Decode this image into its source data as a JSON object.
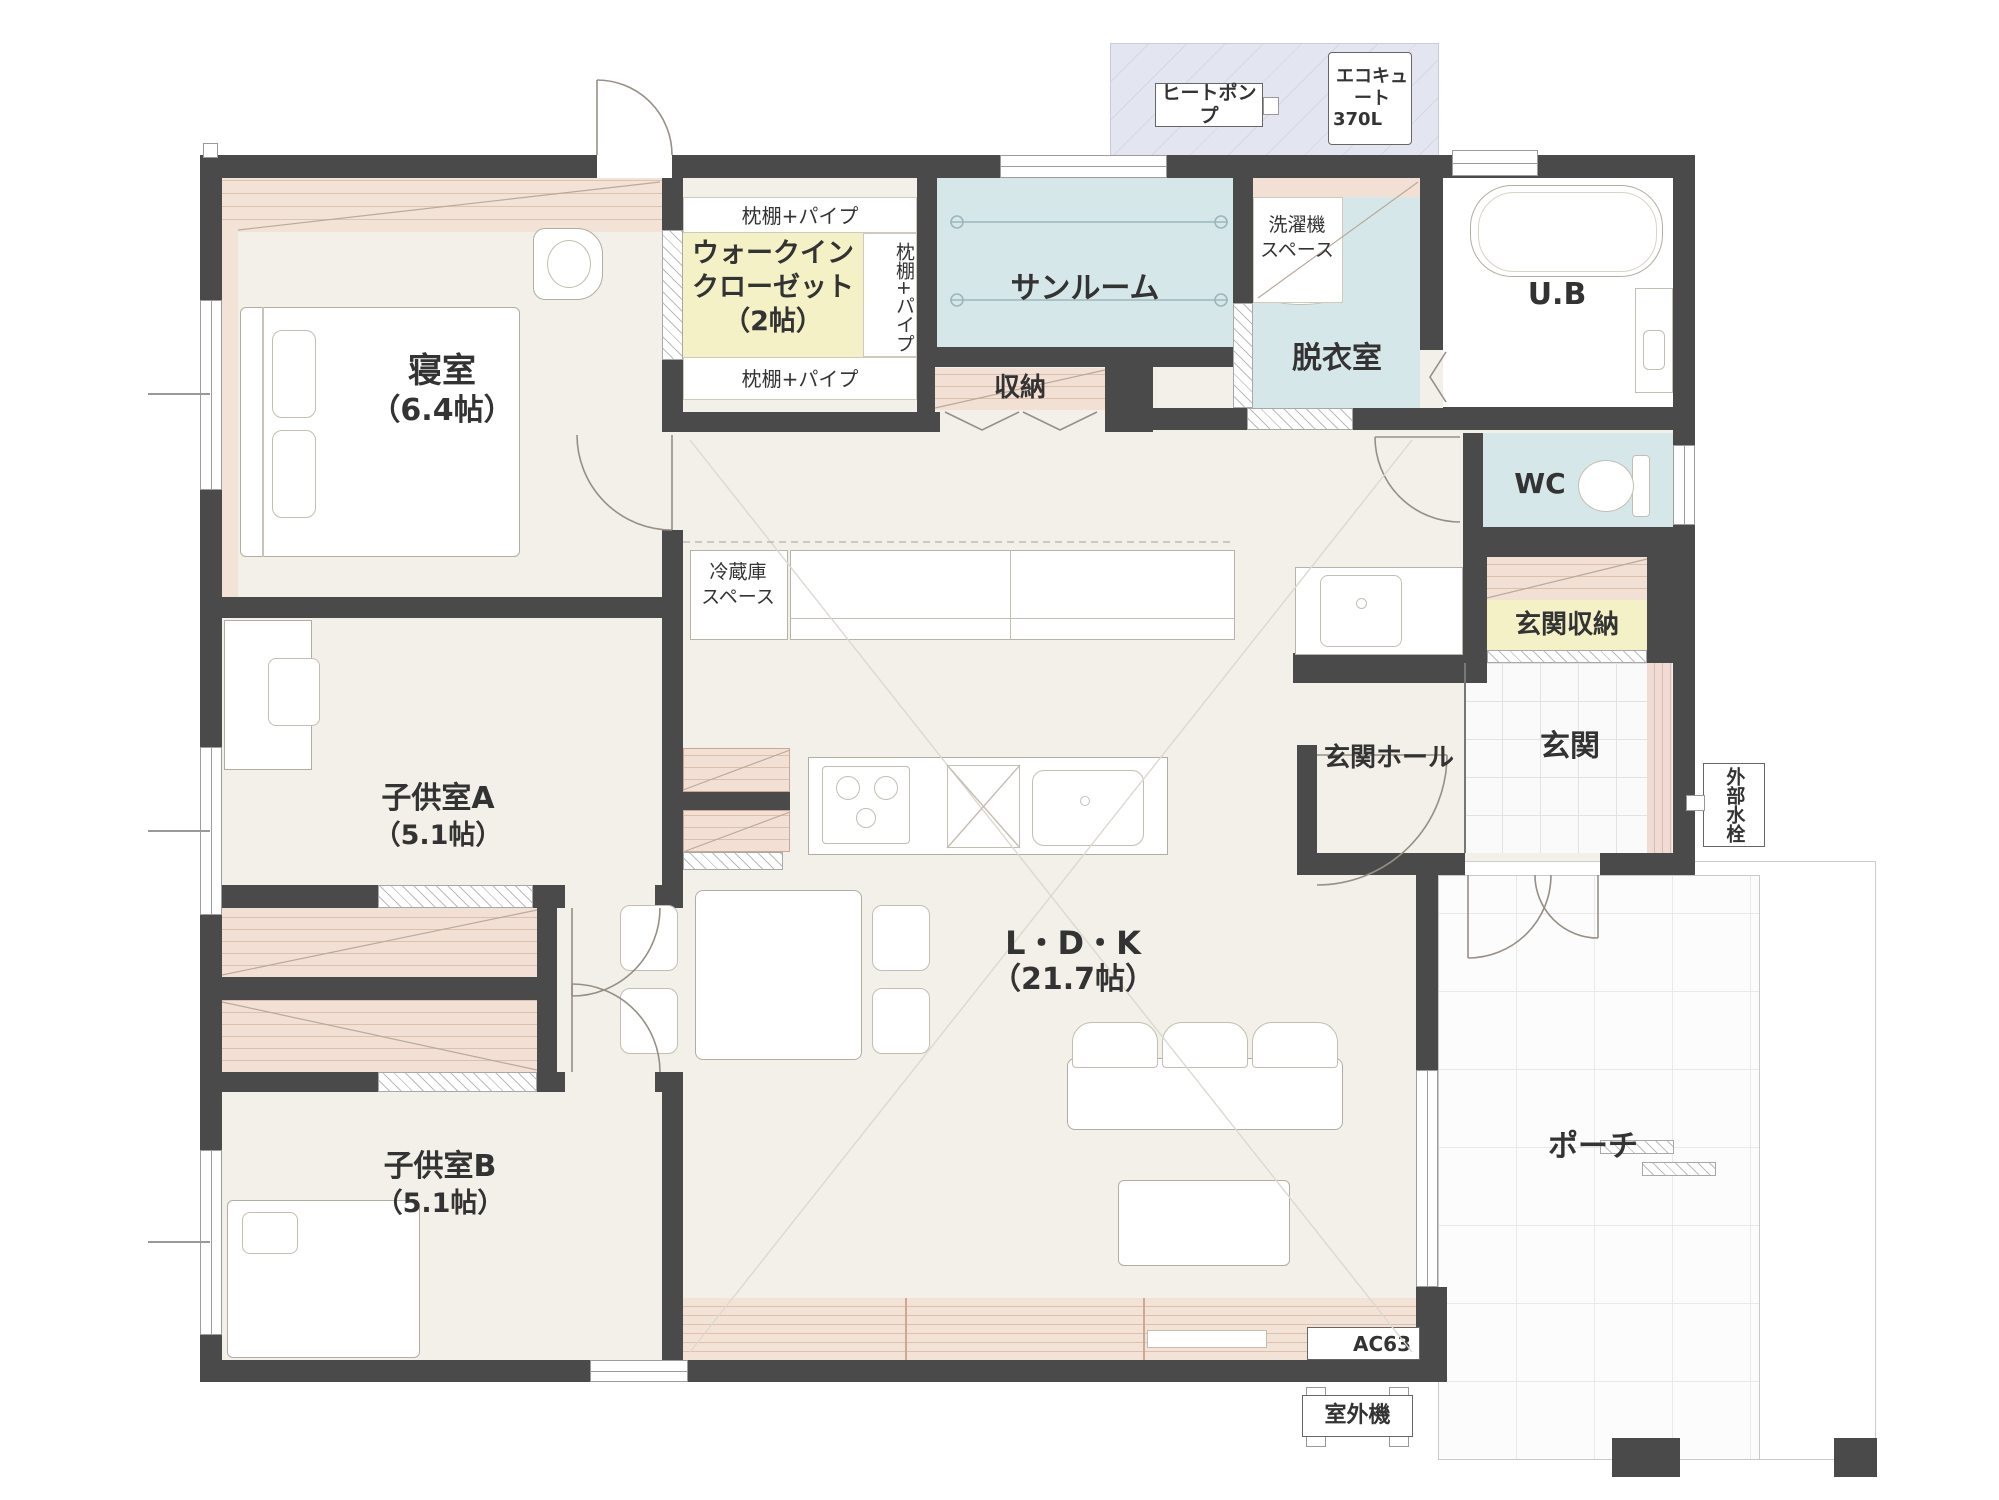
{
  "title": "1階平面図",
  "colors": {
    "wall": "#4a4a4a",
    "floor": "#f2f0e9",
    "wet_blue": "#d6e7e9",
    "closet_yellow": "#f4f1c6",
    "wood_pink": "#f3e0d4",
    "equip_pad": "#e3e5f1"
  },
  "rooms": {
    "bedroom": {
      "name": "寝室",
      "size": "（6.4帖）"
    },
    "wic": {
      "line1": "ウォークイン",
      "line2": "クローゼット",
      "line3": "（2帖）"
    },
    "sunroom": {
      "name": "サンルーム"
    },
    "storage": {
      "name": "収納"
    },
    "dressing": {
      "name": "脱衣室"
    },
    "bath": {
      "name": "U.B"
    },
    "wc": {
      "name": "WC"
    },
    "entrance_storage": {
      "name": "玄関収納"
    },
    "entrance_hall": {
      "name": "玄関ホール"
    },
    "entrance": {
      "name": "玄関"
    },
    "kids_a": {
      "name": "子供室A",
      "size": "（5.1帖）"
    },
    "kids_b": {
      "name": "子供室B",
      "size": "（5.1帖）"
    },
    "ldk": {
      "name": "L・D・K",
      "size": "（21.7帖）"
    },
    "porch": {
      "name": "ポーチ"
    }
  },
  "annotations": {
    "shelf_pipe": "枕棚+パイプ",
    "washer_line1": "洗濯機",
    "washer_line2": "スペース",
    "fridge_line1": "冷蔵庫",
    "fridge_line2": "スペース",
    "heat_pump": "ヒートポンプ",
    "ecocute_line1": "エコキュート",
    "ecocute_line2": "370L",
    "outdoor_faucet": "外部水栓",
    "outdoor_unit": "室外機",
    "ac": "AC63"
  }
}
